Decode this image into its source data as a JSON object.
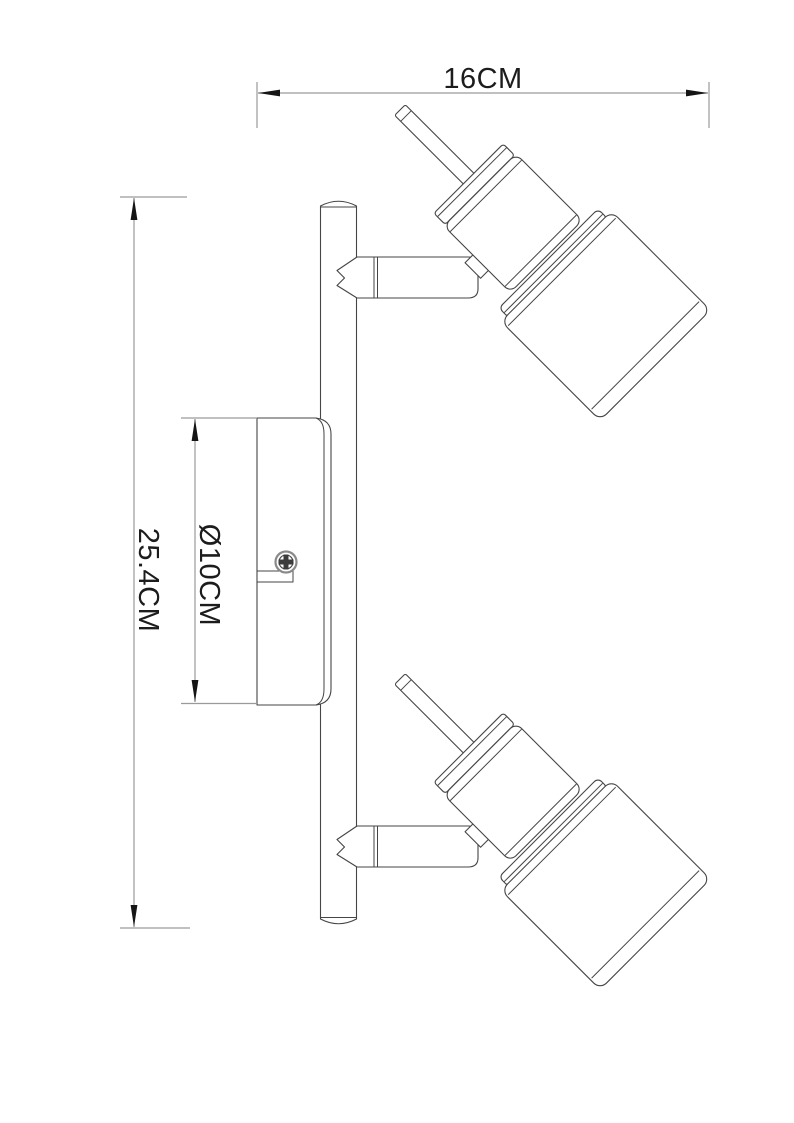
{
  "drawing": {
    "title": "Two-head ceiling spotlight dimensional drawing",
    "dimensions": {
      "width_label": "16CM",
      "height_label": "25.4CM",
      "diameter_label": "Ø10CM"
    },
    "components": {
      "bar": "mounting bar",
      "plate": "wall canopy plate",
      "screw": "phillips screw",
      "spotlight_top": "adjustable spot head (top)",
      "spotlight_bottom": "adjustable spot head (bottom)"
    },
    "colors": {
      "outline": "#454545",
      "dimension_line": "#9a9a9a",
      "arrow": "#151515",
      "text": "#1c1c1c",
      "background": "#ffffff"
    }
  }
}
